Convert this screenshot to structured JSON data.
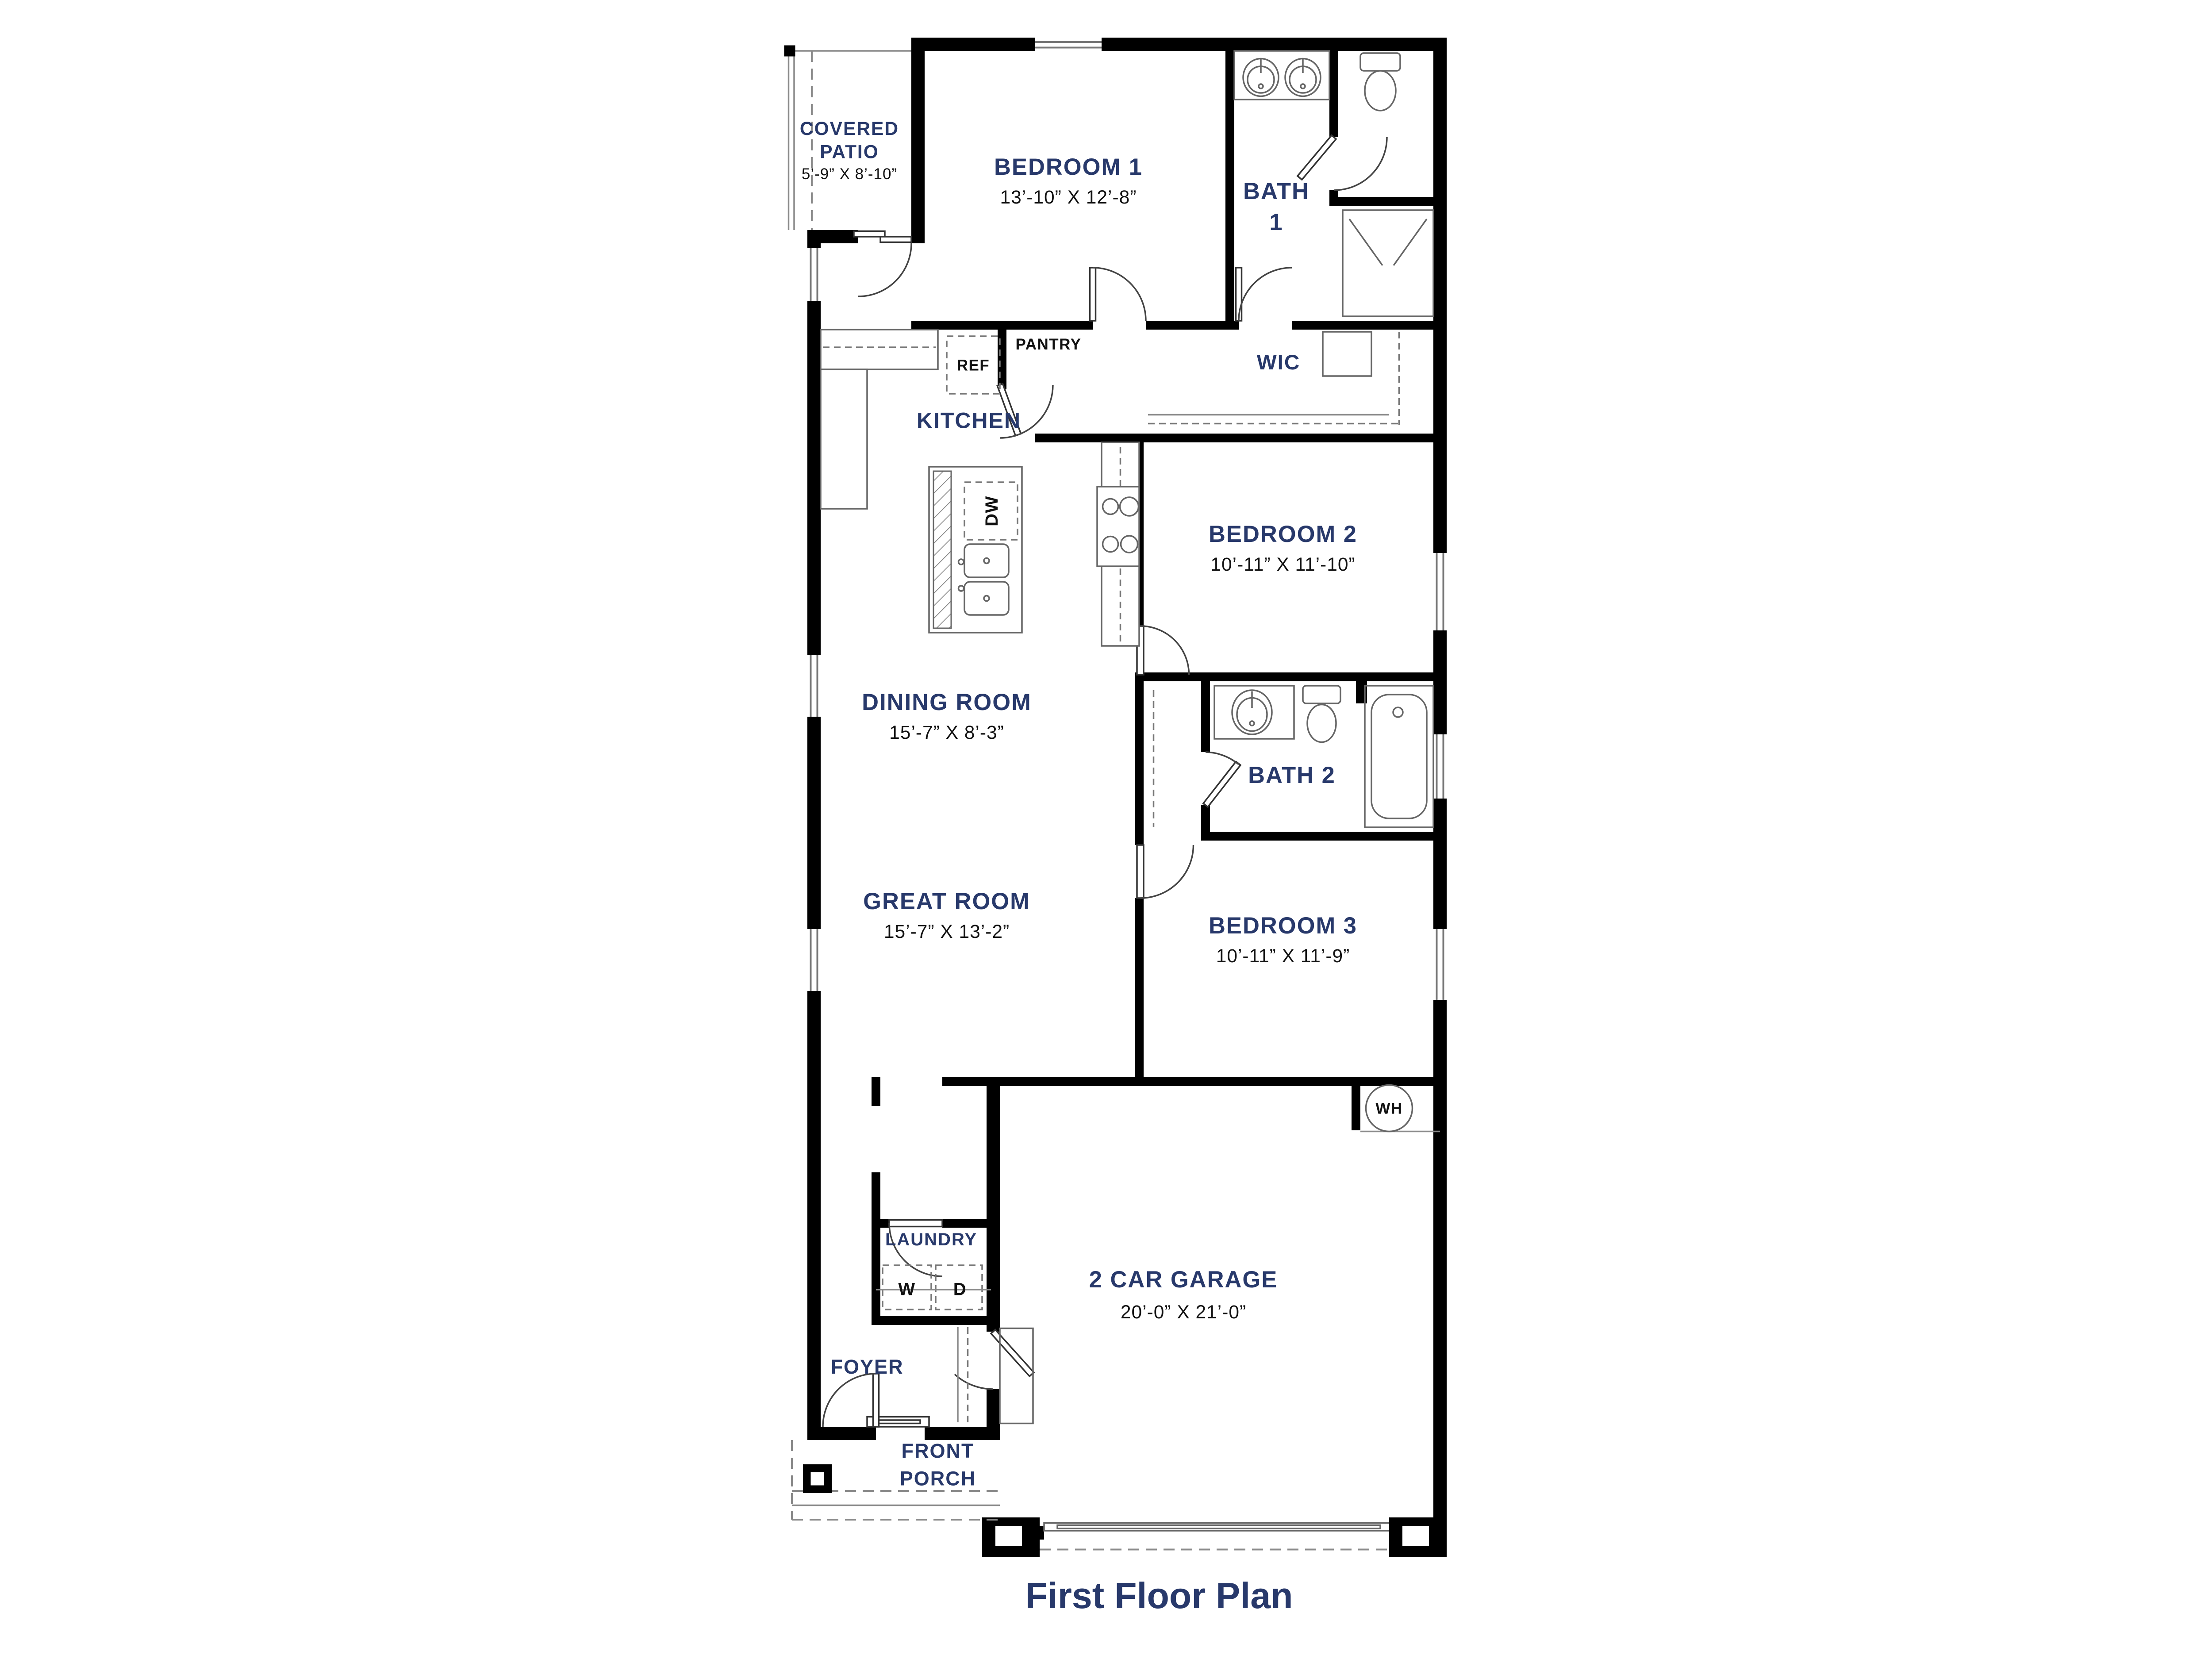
{
  "title": "First Floor Plan",
  "colors": {
    "accent_navy": "#28396b",
    "wall_black": "#000000",
    "fixture_gray": "#8a8a8a",
    "background": "#ffffff"
  },
  "rooms": {
    "covered_patio": {
      "name_line1": "COVERED",
      "name_line2": "PATIO",
      "dims": "5’-9” X 8’-10”"
    },
    "bedroom1": {
      "name": "BEDROOM 1",
      "dims": "13’-10” X 12’-8”"
    },
    "bath1": {
      "name_line1": "BATH",
      "name_line2": "1"
    },
    "wic": {
      "name": "WIC"
    },
    "pantry": {
      "name": "PANTRY"
    },
    "kitchen": {
      "name": "KITCHEN"
    },
    "dining_room": {
      "name": "DINING ROOM",
      "dims": "15’-7” X 8’-3”"
    },
    "bedroom2": {
      "name": "BEDROOM 2",
      "dims": "10’-11” X 11’-10”"
    },
    "bath2": {
      "name": "BATH 2"
    },
    "great_room": {
      "name": "GREAT ROOM",
      "dims": "15’-7” X 13’-2”"
    },
    "bedroom3": {
      "name": "BEDROOM 3",
      "dims": "10’-11” X 11’-9”"
    },
    "laundry": {
      "name": "LAUNDRY"
    },
    "foyer": {
      "name": "FOYER"
    },
    "front_porch": {
      "name_line1": "FRONT",
      "name_line2": "PORCH"
    },
    "garage": {
      "name": "2 CAR GARAGE",
      "dims": "20’-0” X 21’-0”"
    }
  },
  "appliances": {
    "refrigerator": "REF",
    "dishwasher": "DW",
    "washer": "W",
    "dryer": "D",
    "water_heater": "WH"
  }
}
